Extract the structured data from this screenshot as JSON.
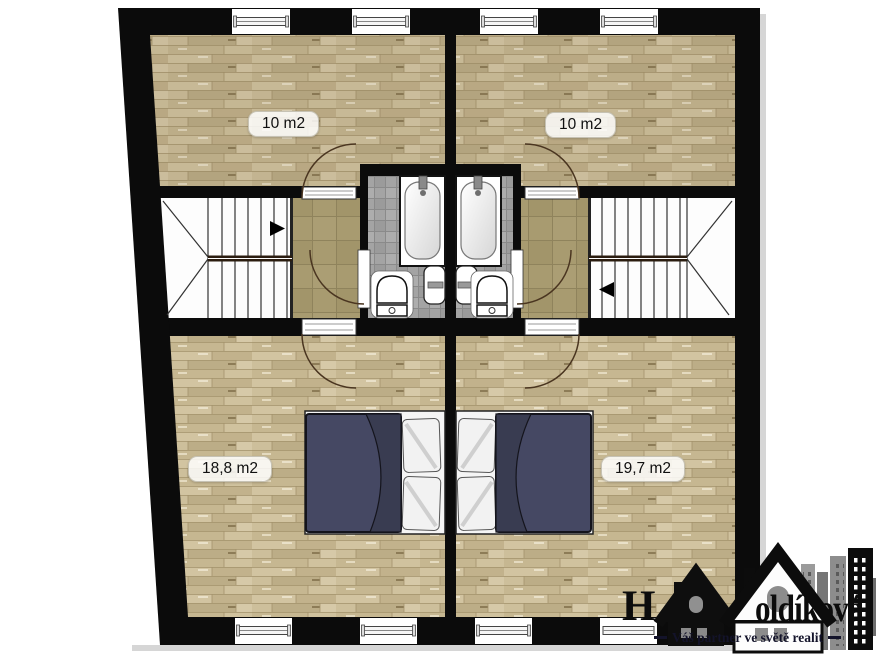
{
  "plan": {
    "rooms": [
      {
        "id": "room-upper-left",
        "area": "10 m2"
      },
      {
        "id": "room-upper-right",
        "area": "10 m2"
      },
      {
        "id": "room-lower-left",
        "area": "18,8 m2"
      },
      {
        "id": "room-lower-right",
        "area": "19,7 m2"
      }
    ]
  },
  "logo": {
    "brand_fragment_left": "H",
    "brand_fragment_right": "oldíková",
    "tagline": "Váš partner ve světě realit"
  },
  "colors": {
    "wall": "#0b0b0b",
    "wood_floor": "#c9ba96",
    "hall_tile": "#a89b70",
    "bath_tile": "#a4a4a4",
    "bed_cover": "#454863"
  }
}
